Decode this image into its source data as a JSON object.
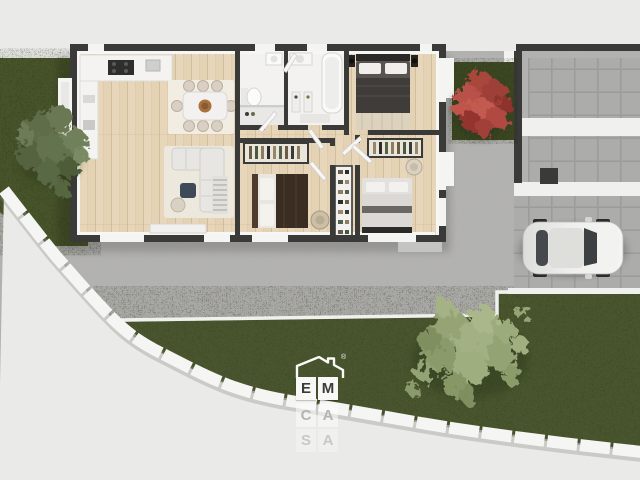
{
  "meta": {
    "description": "Top-down 3D rendered floor plan of a single-storey house with garden, driveway, carport and parked car",
    "canvas": {
      "width": 640,
      "height": 480
    }
  },
  "logo": {
    "brand": "EMCASA",
    "row1": [
      "E",
      "M"
    ],
    "registered_mark": "®",
    "reflection_rows": [
      [
        "C",
        "A"
      ],
      [
        "S",
        "A"
      ]
    ]
  },
  "palette": {
    "background": "#eaeae8",
    "patio_concrete": "#b6b5b3",
    "wall_dark": "#3a3a38",
    "wood_floor": "#e4d2b4",
    "bath_floor": "#f3f2f0",
    "lawn_green": "#49562e",
    "tree_green_left": "#64734d",
    "tree_red": "#b04a42",
    "tree_sage": "#9aa97e",
    "fence_white": "#f5f5f3",
    "driveway_tile": "#a9a9a6",
    "car_silver": "#ececea",
    "logo_box": "#f8f8f6",
    "logo_letter": "#3b3b39"
  },
  "scene": {
    "rooms": [
      "kitchen",
      "living-dining-room",
      "bathroom-1",
      "bathroom-2",
      "bedroom-1",
      "bedroom-2",
      "bedroom-3",
      "hallway"
    ],
    "outdoor": [
      "left-lawn",
      "bottom-lawn",
      "patio",
      "driveway-slabs",
      "carport",
      "curved-perimeter-fence",
      "red-tree-planter"
    ],
    "objects": [
      "kitchen-counter-with-cooktop",
      "dining-table-with-eight-chairs",
      "corner-sofa",
      "coffee-table",
      "radiator",
      "tv-sideboard",
      "toilet",
      "shower",
      "bathtub",
      "washbasin",
      "double-bed-dark",
      "double-bed-brown",
      "double-bed-light",
      "wardrobe-open",
      "wardrobe-open",
      "hall-shelf",
      "round-chair",
      "parked-silver-car",
      "green-tree",
      "red-tree",
      "sage-tree"
    ]
  }
}
